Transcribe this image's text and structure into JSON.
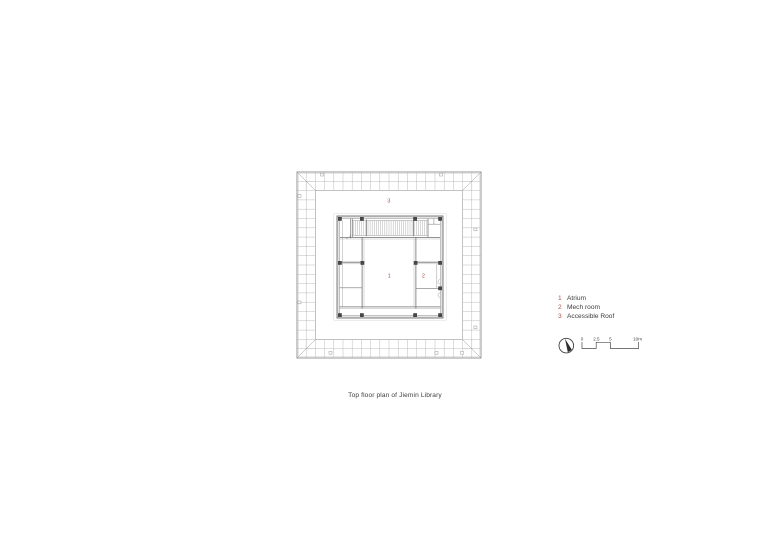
{
  "caption": "Top floor plan of Jiemin Library",
  "plan": {
    "labels": {
      "atrium": "1",
      "mech_room": "2",
      "accessible_roof": "3"
    }
  },
  "legend": {
    "items": [
      {
        "number": "1",
        "label": "Atrium"
      },
      {
        "number": "2",
        "label": "Mech room"
      },
      {
        "number": "3",
        "label": "Accessible Roof"
      }
    ]
  },
  "scalebar": {
    "labels": [
      "0",
      "2.5",
      "5",
      "10m"
    ]
  },
  "icons": {
    "north_arrow": "north-arrow-compass-needle-icon"
  },
  "colors": {
    "accent_red": "#b0544c",
    "grid_line": "#b4b4b4",
    "wall_line": "#6f6f6f",
    "hatch_line": "#a6a6a6",
    "column_fill": "#474747",
    "text": "#3b3b3b"
  }
}
